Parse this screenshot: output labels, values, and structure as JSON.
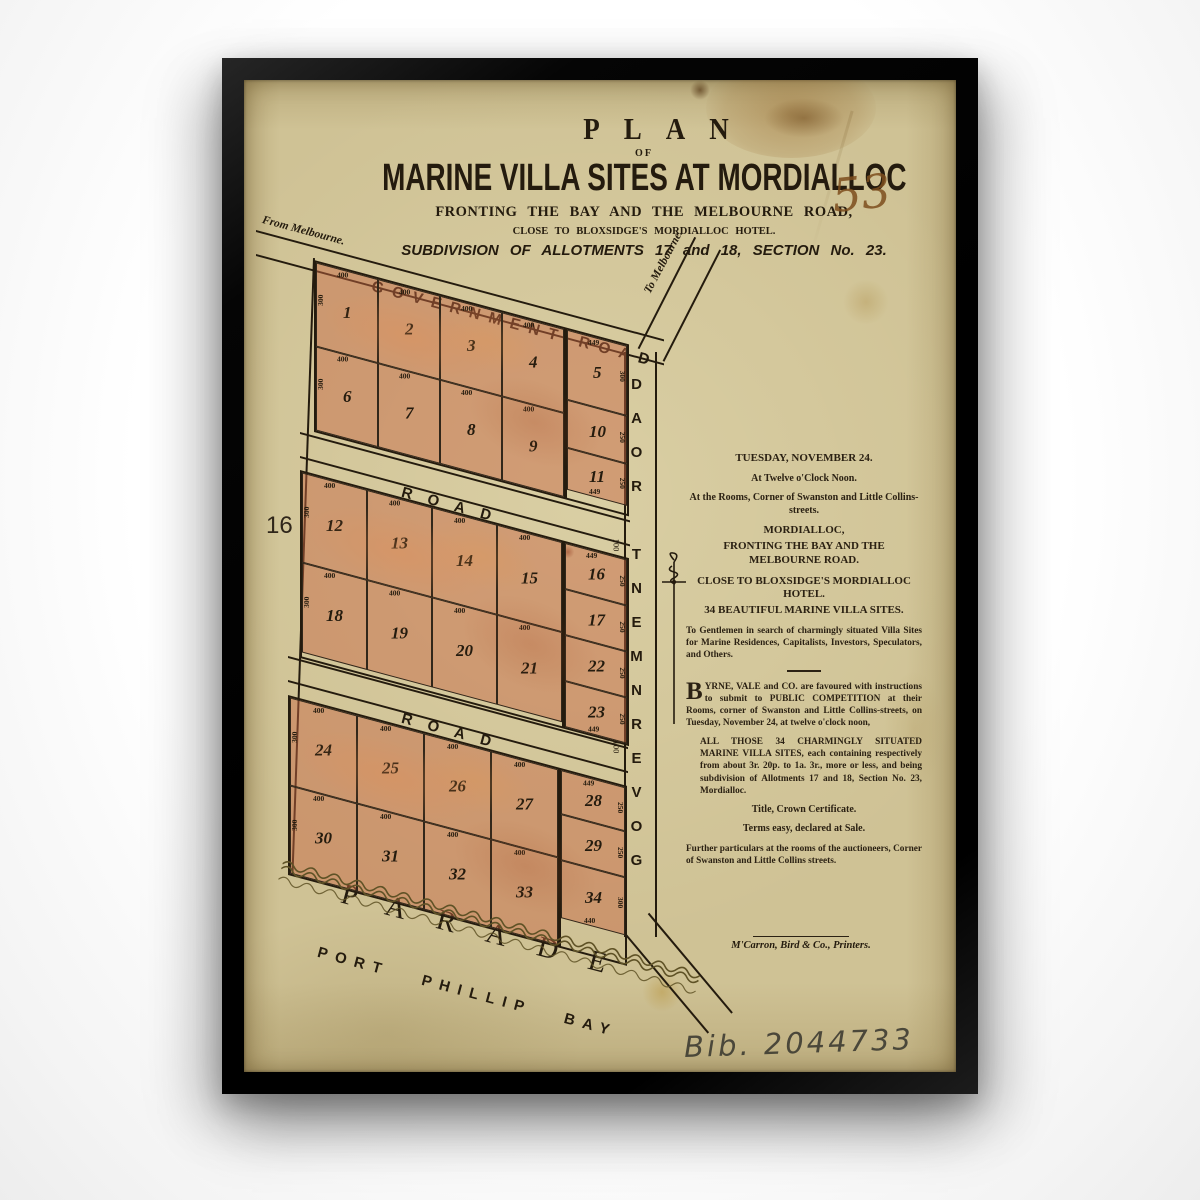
{
  "header": {
    "plan_word": "PLAN",
    "of_word": "OF",
    "title": "MARINE VILLA SITES AT MORDIALLOC",
    "subtitle1": "FRONTING THE BAY AND THE MELBOURNE ROAD,",
    "subtitle2": "CLOSE TO BLOXSIDGE'S MORDIALLOC HOTEL.",
    "subtitle3": "SUBDIVISION OF ALLOTMENTS 17 and 18, SECTION No. 23.",
    "handwritten_number": "53"
  },
  "plan": {
    "adjacent_section": "16",
    "roads": {
      "government_road_top": "GOVERNMENT ROAD",
      "government_road_side": "GOVERNMENT ROAD",
      "cross_road_1": "ROAD",
      "cross_road_2": "ROAD",
      "parade": "PARADE",
      "bay": "PORT PHILLIP BAY",
      "from_melbourne": "From Melbourne.",
      "to_melbourne": "To Melbourne."
    },
    "dims": {
      "frontage": "400",
      "depth": "300",
      "small_depth": "250",
      "road_width": "100",
      "corner": "449",
      "corner2": "440"
    },
    "blocks": [
      {
        "row1": [
          "1",
          "2",
          "3",
          "4"
        ],
        "row2": [
          "6",
          "7",
          "8",
          "9"
        ],
        "right": [
          "5",
          "10",
          "11"
        ]
      },
      {
        "row1": [
          "12",
          "13",
          "14",
          "15"
        ],
        "row2": [
          "18",
          "19",
          "20",
          "21"
        ],
        "right": [
          "16",
          "17",
          "22",
          "23"
        ]
      },
      {
        "row1": [
          "24",
          "25",
          "26",
          "27"
        ],
        "row2": [
          "30",
          "31",
          "32",
          "33"
        ],
        "right": [
          "28",
          "29",
          "34"
        ]
      }
    ]
  },
  "notice": {
    "date": "TUESDAY, NOVEMBER 24.",
    "time": "At Twelve o'Clock Noon.",
    "venue": "At the Rooms, Corner of Swanston and Little Collins-streets.",
    "place": "MORDIALLOC,",
    "fronting": "FRONTING THE BAY AND THE MELBOURNE ROAD.",
    "close_to": "CLOSE TO BLOXSIDGE'S MORDIALLOC HOTEL.",
    "sites": "34 BEAUTIFUL MARINE VILLA SITES.",
    "gentlemen": "To Gentlemen in search of charmingly situated Villa Sites for Marine Residences, Capitalists, Investors, Speculators, and Others.",
    "dropcap": "B",
    "byrne": "YRNE, VALE and CO. are favoured with instructions to submit to PUBLIC COMPETITION at their Rooms, corner of Swanston and Little Collins-streets, on Tuesday, November 24, at twelve o'clock noon,",
    "all_those": "ALL THOSE 34 CHARMINGLY SITUATED MARINE VILLA SITES, each containing respectively from about 3r. 20p. to 1a. 3r., more or less, and being subdivision of Allotments 17 and 18, Section No. 23, Mordialloc.",
    "title_line": "Title, Crown Certificate.",
    "terms_line": "Terms easy, declared at Sale.",
    "further": "Further particulars at the rooms of the auctioneers, Corner of Swanston and Little Collins streets."
  },
  "printer_line": "M'Carron, Bird & Co., Printers.",
  "catalog_number": "Bib. 2044733",
  "colors": {
    "paper": "#cfc295",
    "lot_fill": "#d9a184",
    "frame": "#0a0a0a",
    "ink": "#241b0e"
  }
}
